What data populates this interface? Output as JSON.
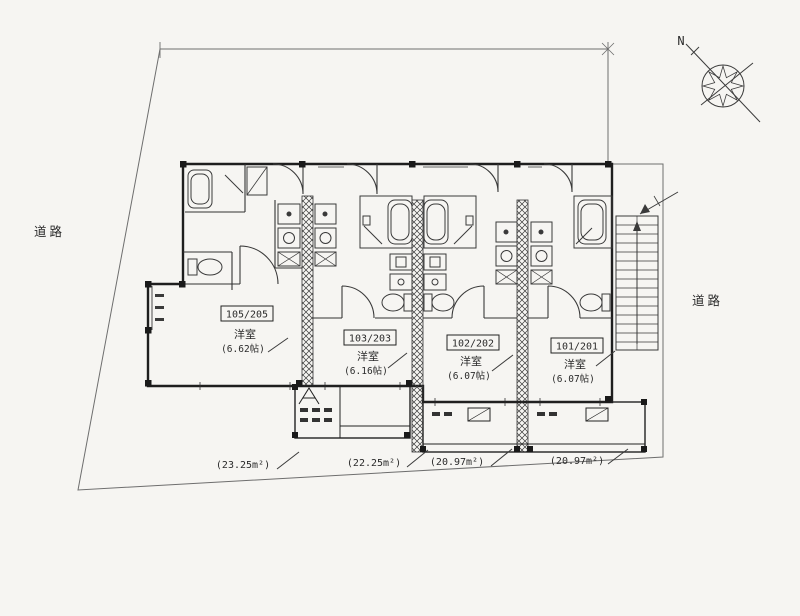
{
  "document": {
    "type": "site-floor-plan",
    "paper_color": "#f6f5f2",
    "line_color": "#2b2b2b"
  },
  "compass": {
    "north_label": "N"
  },
  "roads": {
    "left": "道路",
    "right": "道路"
  },
  "units": [
    {
      "number": "105/205",
      "room": "洋室",
      "size": "(6.62帖)",
      "floor_area": "(23.25m²)"
    },
    {
      "number": "103/203",
      "room": "洋室",
      "size": "(6.16帖)",
      "floor_area": "(22.25m²)"
    },
    {
      "number": "102/202",
      "room": "洋室",
      "size": "(6.07帖)",
      "floor_area": "(20.97m²)"
    },
    {
      "number": "101/201",
      "room": "洋室",
      "size": "(6.07帖)",
      "floor_area": "(20.97m²)"
    }
  ]
}
